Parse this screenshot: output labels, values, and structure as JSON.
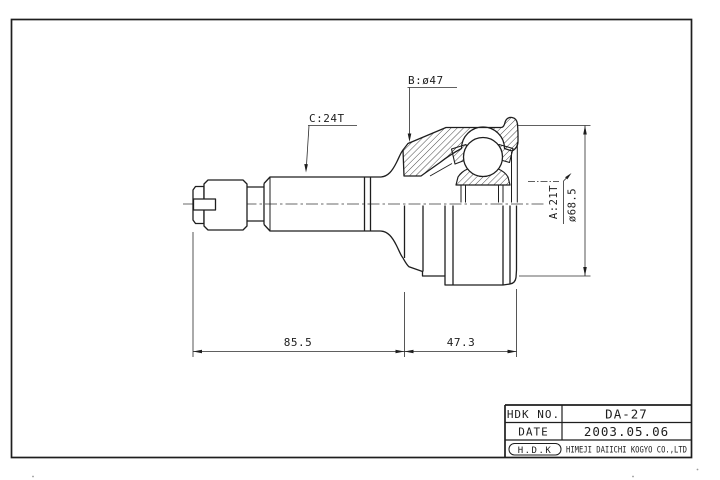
{
  "drawing": {
    "labels": {
      "spline_c": "C:24T",
      "dia_b": "B:ø47",
      "spline_a": "A:21T",
      "dia_outer": "ø68.5",
      "dim_left": "85.5",
      "dim_right": "47.3"
    },
    "title_block": {
      "row1_label": "HDK NO.",
      "row1_value": "DA-27",
      "row2_label": "DATE",
      "row2_value": "2003.05.06",
      "logo": "H.D.K",
      "company": "HIMEJI DAIICHI KOGYO CO.,LTD"
    },
    "colors": {
      "line": "#1e1e1e",
      "background": "#ffffff"
    }
  }
}
